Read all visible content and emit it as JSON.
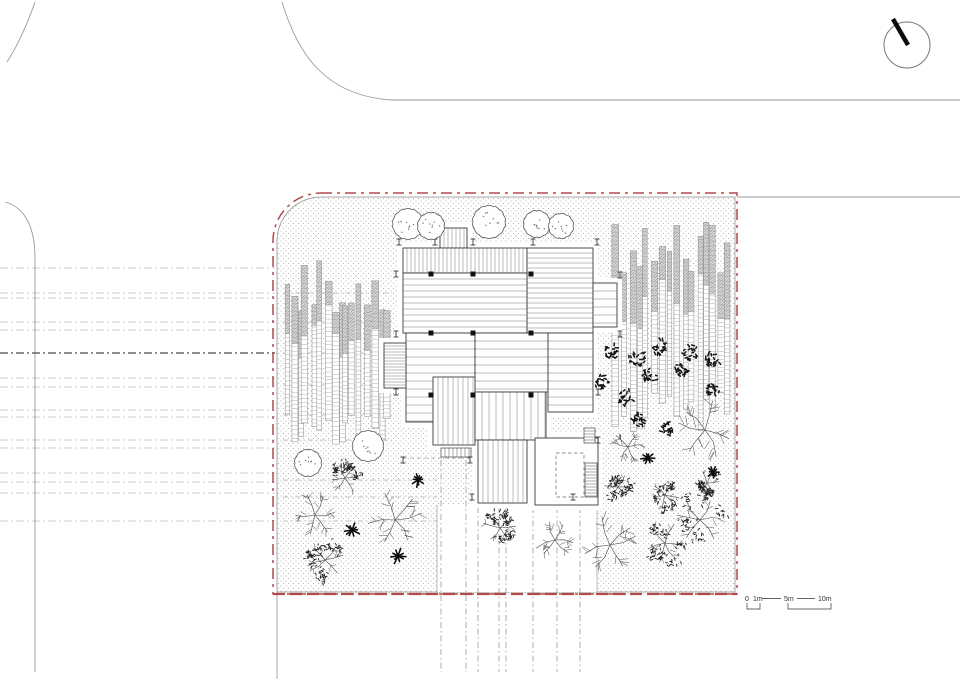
{
  "meta": {
    "drawing_type": "architectural site plan",
    "orientation_device": "north-arrow",
    "interactive": false
  },
  "colors": {
    "background": "#ffffff",
    "boundary_red": "#b24a4a",
    "fence_gray": "#8f8f8f",
    "road_gray": "#9a9a9a",
    "line_dark": "#3a3a3a",
    "hatch_gray": "#6a6a6a",
    "stipple_gray": "#a3a3a3",
    "tree_line": "#4a4a4a",
    "shrub_dark": "#141414",
    "bamboo_fill": "#d6d6d6"
  },
  "north_arrow": {
    "name": "north-arrow",
    "cx": 907,
    "cy": 45,
    "r": 23,
    "needle": {
      "x1": 893,
      "y1": 19,
      "x2": 908,
      "y2": 45
    }
  },
  "scale_bar": {
    "labels": [
      "0",
      "1m",
      "5m",
      "10m"
    ],
    "label_x": [
      745,
      753,
      784,
      818
    ],
    "label_y": 601,
    "ticks": {
      "line1": [
        762,
        598.5,
        781,
        598.5
      ],
      "line2": [
        797,
        598.5,
        815,
        598.5
      ],
      "bracket_small": [
        747,
        603,
        760,
        609
      ],
      "bracket_large": [
        788,
        603,
        831,
        609
      ]
    }
  },
  "site": {
    "x": 277,
    "y": 197,
    "w": 458,
    "h": 395,
    "corner_radius": 44,
    "red_offset": 4,
    "red_dash": "11 5 3 5",
    "bottom_double_red": true
  },
  "roads": {
    "curves": [
      {
        "d": "M35,2 C28,22 18,45 7,62",
        "w": 0.9
      },
      {
        "d": "M282,2 C297,52 324,96 392,100 L960,100",
        "w": 0.9
      },
      {
        "d": "M5,202 C20,206 35,220 35,258 L35,672",
        "w": 0.9
      }
    ],
    "lines": [
      {
        "x1": 737,
        "y1": 197,
        "x2": 960,
        "y2": 197,
        "w": 0.9
      },
      {
        "x1": 277,
        "y1": 592,
        "x2": 277,
        "y2": 679,
        "w": 0.9
      }
    ],
    "dashed_h": [
      {
        "y": 268
      },
      {
        "y": 293
      },
      {
        "y": 298
      },
      {
        "y": 322
      },
      {
        "y": 330
      },
      {
        "y": 353,
        "bold": true
      },
      {
        "y": 378
      },
      {
        "y": 387
      },
      {
        "y": 410
      },
      {
        "y": 417
      },
      {
        "y": 440
      },
      {
        "y": 448
      },
      {
        "y": 473
      },
      {
        "y": 482
      },
      {
        "y": 493
      },
      {
        "y": 521
      }
    ],
    "dashed_h_x1": 0,
    "dashed_h_x2": 275
  },
  "guides": {
    "bamboo_rows": {
      "ys": [
        293,
        322,
        353,
        385,
        415,
        440
      ],
      "x1": 283,
      "x2": 392
    },
    "garden_rows": {
      "ys": [
        480,
        497,
        521
      ],
      "x1": 283,
      "x2": 437
    },
    "vertical_dashed": [
      {
        "x": 441,
        "y1": 460,
        "y2": 672
      },
      {
        "x": 466,
        "y1": 460,
        "y2": 672
      },
      {
        "x": 478,
        "y1": 507,
        "y2": 672
      },
      {
        "x": 499,
        "y1": 507,
        "y2": 672
      },
      {
        "x": 506,
        "y1": 507,
        "y2": 672
      },
      {
        "x": 533,
        "y1": 507,
        "y2": 672
      },
      {
        "x": 557,
        "y1": 507,
        "y2": 672
      },
      {
        "x": 580,
        "y1": 507,
        "y2": 672
      }
    ],
    "dim_line": {
      "x1": 403,
      "y1": 458,
      "x2": 471,
      "y2": 458
    }
  },
  "path_area": {
    "x": 437,
    "y": 505,
    "w": 160,
    "h": 87
  },
  "building": {
    "parts": [
      {
        "x": 440,
        "y": 228,
        "w": 27,
        "h": 20,
        "hatch": "v",
        "s": 4
      },
      {
        "x": 403,
        "y": 248,
        "w": 124,
        "h": 25,
        "hatch": "v",
        "s": 4
      },
      {
        "x": 527,
        "y": 248,
        "w": 66,
        "h": 85,
        "hatch": "h",
        "s": 5
      },
      {
        "x": 403,
        "y": 273,
        "w": 124,
        "h": 60,
        "hatch": "h",
        "s": 6
      },
      {
        "x": 593,
        "y": 283,
        "w": 24,
        "h": 44,
        "hatch": "h",
        "s": 8
      },
      {
        "x": 406,
        "y": 333,
        "w": 69,
        "h": 89,
        "hatch": "h",
        "s": 8
      },
      {
        "x": 475,
        "y": 333,
        "w": 73,
        "h": 59,
        "hatch": "h",
        "s": 8
      },
      {
        "x": 548,
        "y": 333,
        "w": 45,
        "h": 79,
        "hatch": "h",
        "s": 8
      },
      {
        "x": 384,
        "y": 343,
        "w": 22,
        "h": 45,
        "hatch": "h",
        "s": 3
      },
      {
        "x": 433,
        "y": 377,
        "w": 42,
        "h": 68,
        "hatch": "v",
        "s": 5
      },
      {
        "x": 475,
        "y": 392,
        "w": 71,
        "h": 48,
        "hatch": "v",
        "s": 7
      },
      {
        "x": 478,
        "y": 440,
        "w": 49,
        "h": 63,
        "hatch": "v",
        "s": 5
      },
      {
        "x": 535,
        "y": 438,
        "w": 63,
        "h": 67,
        "hatch": "none",
        "s": 0
      }
    ],
    "columns": {
      "xs": [
        431,
        473,
        531
      ],
      "ys": [
        274,
        333,
        395
      ],
      "size": 5
    },
    "markers": [
      [
        399,
        242
      ],
      [
        435,
        242
      ],
      [
        473,
        242
      ],
      [
        533,
        242
      ],
      [
        597,
        242
      ],
      [
        396,
        274
      ],
      [
        396,
        334
      ],
      [
        396,
        392
      ],
      [
        620,
        275
      ],
      [
        620,
        334
      ],
      [
        598,
        392
      ],
      [
        598,
        440
      ],
      [
        403,
        460
      ],
      [
        470,
        460
      ],
      [
        472,
        497
      ],
      [
        573,
        497
      ]
    ],
    "courtyard_dash": {
      "x": 556,
      "y": 453,
      "w": 28,
      "h": 44
    },
    "ladder": {
      "x": 585,
      "y": 463,
      "w": 12,
      "h": 34,
      "step": 3
    },
    "mini_stair": {
      "x": 584,
      "y": 428,
      "w": 11,
      "h": 15,
      "step": 3
    },
    "stair_strip": {
      "x": 441,
      "y": 448,
      "w": 30,
      "h": 9,
      "step": 4
    }
  },
  "bamboo": {
    "groves": [
      {
        "x": 283,
        "y": 260,
        "w": 108,
        "h": 190,
        "count": 16,
        "seed": 3
      },
      {
        "x": 613,
        "y": 216,
        "w": 120,
        "h": 218,
        "count": 16,
        "seed": 9
      }
    ]
  },
  "trees": [
    {
      "t": "round",
      "x": 408,
      "y": 224,
      "r": 15
    },
    {
      "t": "round",
      "x": 431,
      "y": 226,
      "r": 13
    },
    {
      "t": "round",
      "x": 489,
      "y": 222,
      "r": 16
    },
    {
      "t": "round",
      "x": 537,
      "y": 224,
      "r": 13
    },
    {
      "t": "round",
      "x": 561,
      "y": 226,
      "r": 12
    },
    {
      "t": "round",
      "x": 308,
      "y": 463,
      "r": 13
    },
    {
      "t": "round",
      "x": 368,
      "y": 446,
      "r": 15
    },
    {
      "t": "leafy",
      "x": 345,
      "y": 478,
      "r": 16
    },
    {
      "t": "leafy",
      "x": 325,
      "y": 560,
      "r": 20
    },
    {
      "t": "leafy",
      "x": 500,
      "y": 528,
      "r": 18
    },
    {
      "t": "leafy",
      "x": 665,
      "y": 495,
      "r": 15
    },
    {
      "t": "leafy",
      "x": 665,
      "y": 543,
      "r": 21
    },
    {
      "t": "leafy",
      "x": 707,
      "y": 483,
      "r": 13
    },
    {
      "t": "leafy",
      "x": 618,
      "y": 487,
      "r": 14
    },
    {
      "t": "leafy",
      "x": 700,
      "y": 520,
      "r": 26
    },
    {
      "t": "branchy",
      "x": 315,
      "y": 515,
      "r": 23
    },
    {
      "t": "branchy",
      "x": 395,
      "y": 520,
      "r": 29
    },
    {
      "t": "branchy",
      "x": 555,
      "y": 540,
      "r": 21
    },
    {
      "t": "branchy",
      "x": 610,
      "y": 545,
      "r": 30
    },
    {
      "t": "branchy",
      "x": 705,
      "y": 430,
      "r": 32
    },
    {
      "t": "branchy",
      "x": 628,
      "y": 447,
      "r": 17
    },
    {
      "t": "cshrub",
      "x": 612,
      "y": 352,
      "r": 8
    },
    {
      "t": "cshrub",
      "x": 637,
      "y": 358,
      "r": 9
    },
    {
      "t": "cshrub",
      "x": 660,
      "y": 348,
      "r": 8
    },
    {
      "t": "cshrub",
      "x": 690,
      "y": 352,
      "r": 9
    },
    {
      "t": "cshrub",
      "x": 712,
      "y": 360,
      "r": 8
    },
    {
      "t": "cshrub",
      "x": 602,
      "y": 383,
      "r": 8
    },
    {
      "t": "cshrub",
      "x": 648,
      "y": 376,
      "r": 9
    },
    {
      "t": "cshrub",
      "x": 682,
      "y": 370,
      "r": 8
    },
    {
      "t": "cshrub",
      "x": 625,
      "y": 398,
      "r": 8
    },
    {
      "t": "cshrub",
      "x": 712,
      "y": 390,
      "r": 8
    },
    {
      "t": "cshrub",
      "x": 638,
      "y": 420,
      "r": 7
    },
    {
      "t": "cshrub",
      "x": 668,
      "y": 428,
      "r": 7
    },
    {
      "t": "star",
      "x": 418,
      "y": 480,
      "r": 7
    },
    {
      "t": "star",
      "x": 352,
      "y": 530,
      "r": 8
    },
    {
      "t": "star",
      "x": 398,
      "y": 556,
      "r": 8
    },
    {
      "t": "star",
      "x": 648,
      "y": 458,
      "r": 7
    },
    {
      "t": "star",
      "x": 713,
      "y": 472,
      "r": 6
    }
  ]
}
